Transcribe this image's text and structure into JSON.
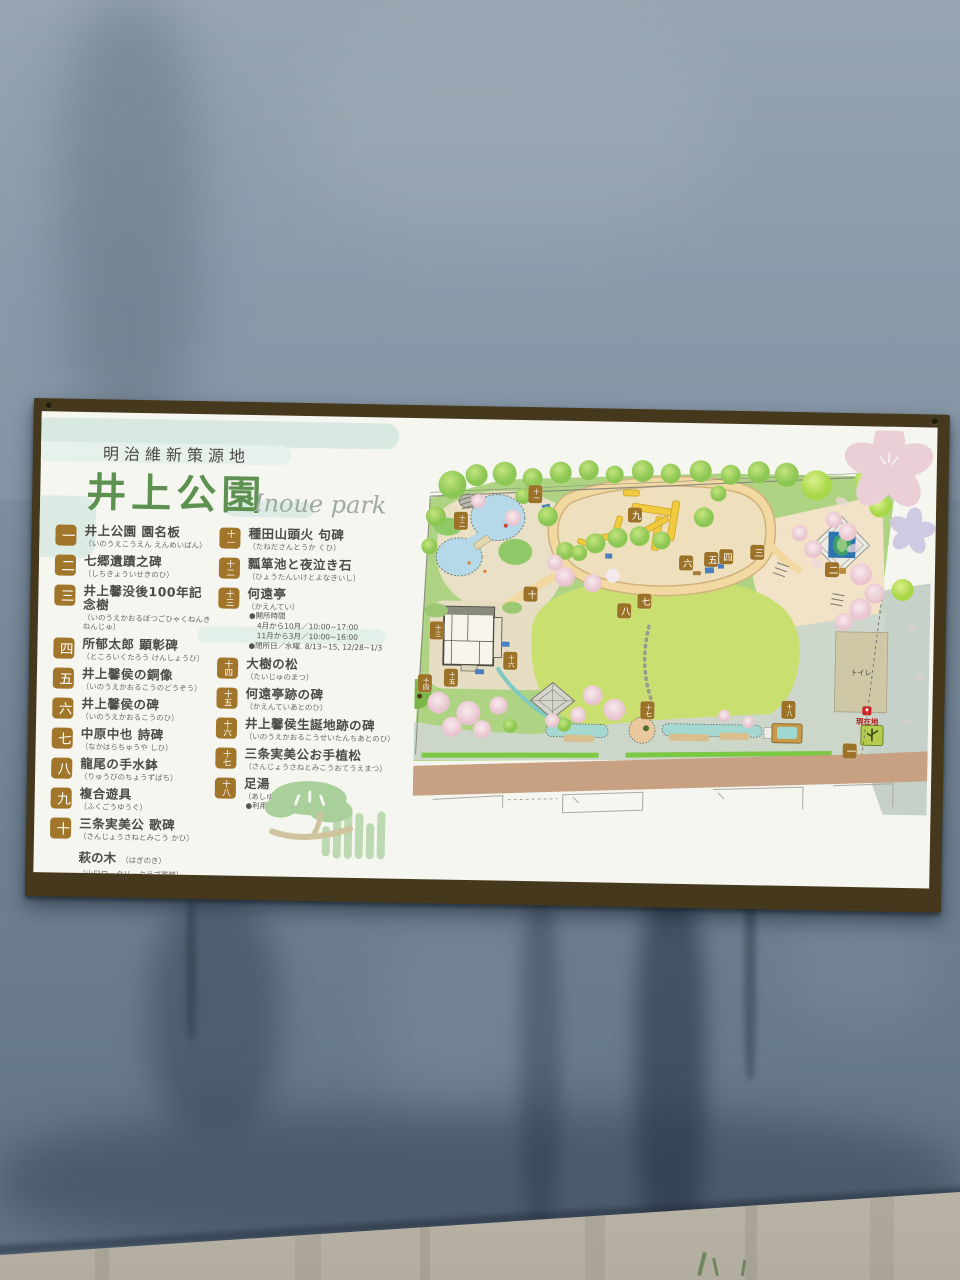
{
  "sign": {
    "header": {
      "region_title": "明治維新策源地",
      "title": "井上公園",
      "title_en": "Inoue park"
    },
    "legend": {
      "left": [
        {
          "num": "一",
          "name": "井上公園 園名板",
          "kana": "（いのうえこうえん えんめいばん）"
        },
        {
          "num": "二",
          "name": "七郷遺蹟之碑",
          "kana": "（しちきょういせきのひ）"
        },
        {
          "num": "三",
          "name": "井上馨没後100年記念樹",
          "kana": "（いのうえかおるぼつごひゃくねんきねんじゅ）"
        },
        {
          "num": "四",
          "name": "所郁太郎 顕彰碑",
          "kana": "（ところいくたろう けんしょうひ）"
        },
        {
          "num": "五",
          "name": "井上馨侯の銅像",
          "kana": "（いのうえかおるこうのどうぞう）"
        },
        {
          "num": "六",
          "name": "井上馨侯の碑",
          "kana": "（いのうえかおるこうのひ）"
        },
        {
          "num": "七",
          "name": "中原中也 詩碑",
          "kana": "（なかはらちゅうや しひ）"
        },
        {
          "num": "八",
          "name": "龍尾の手水鉢",
          "kana": "（りゅうびのちょうずばち）"
        },
        {
          "num": "九",
          "name": "複合遊具",
          "kana": "（ふくごうゆうぐ）"
        },
        {
          "num": "十",
          "name": "三条実美公 歌碑",
          "kana": "（さんじょうさねとみこう かひ）"
        }
      ],
      "extra": {
        "name": "萩の木",
        "kana": "（はぎのき）",
        "note": "〔山口ロータリークラブ寄贈〕"
      },
      "right": [
        {
          "num": "十一",
          "name": "種田山頭火 句碑",
          "kana": "（たねださんとうか くひ）"
        },
        {
          "num": "十二",
          "name": "瓢箪池と夜泣き石",
          "kana": "（ひょうたんいけとよなきいし）"
        },
        {
          "num": "十三",
          "name": "何遠亭",
          "kana": "（かえんてい）",
          "notes": [
            "●開所時間",
            "4月から10月／10:00~17:00",
            "11月から3月／10:00~16:00",
            "●閉所日／水曜. 8/13~15, 12/28~1/3"
          ]
        },
        {
          "num": "十四",
          "name": "大樹の松",
          "kana": "（たいじゅのまつ）"
        },
        {
          "num": "十五",
          "name": "何遠亭跡の碑",
          "kana": "（かえんていあとのひ）"
        },
        {
          "num": "十六",
          "name": "井上馨侯生誕地跡の碑",
          "kana": "（いのうえかおるこうせいたんちあとのひ）"
        },
        {
          "num": "十七",
          "name": "三条実美公お手植松",
          "kana": "（さんじょうさねとみこうおてうえまつ）"
        },
        {
          "num": "十八",
          "name": "足湯",
          "kana": "（あしゆ）",
          "notes": [
            "●利用時間／10:00~22:00"
          ]
        }
      ]
    },
    "map": {
      "toilet_label": "トイレ",
      "current_location_label": "現在地",
      "markers": [
        {
          "n": "一",
          "x": 436,
          "y": 289
        },
        {
          "n": "二",
          "x": 415,
          "y": 108
        },
        {
          "n": "三",
          "x": 340,
          "y": 92
        },
        {
          "n": "四",
          "x": 309,
          "y": 97
        },
        {
          "n": "五",
          "x": 294,
          "y": 100
        },
        {
          "n": "六",
          "x": 269,
          "y": 104
        },
        {
          "n": "七",
          "x": 228,
          "y": 143
        },
        {
          "n": "八",
          "x": 208,
          "y": 153
        },
        {
          "n": "九",
          "x": 217,
          "y": 57
        },
        {
          "n": "十",
          "x": 114,
          "y": 138
        },
        {
          "n": "十一",
          "x": 117,
          "y": 38
        },
        {
          "n": "十二",
          "x": 43,
          "y": 66
        },
        {
          "n": "十三",
          "x": 21,
          "y": 176
        },
        {
          "n": "十四",
          "x": 10,
          "y": 229
        },
        {
          "n": "十五",
          "x": 36,
          "y": 223
        },
        {
          "n": "十六",
          "x": 95,
          "y": 205
        },
        {
          "n": "十七",
          "x": 233,
          "y": 252
        },
        {
          "n": "十八",
          "x": 374,
          "y": 249
        }
      ]
    },
    "colors": {
      "frame_brown": "#46381d",
      "title_green": "#5d9150",
      "badge_brown": "#a1762b",
      "marker_brown": "#9b7227",
      "cloud_mint": "#d8e9e1",
      "sakura_pink": "#ead0d6",
      "pond_blue": "#b5d9e9",
      "lawn_green": "#c9e070",
      "road_tan": "#c7a182",
      "current_location_red": "#b3231f"
    }
  }
}
